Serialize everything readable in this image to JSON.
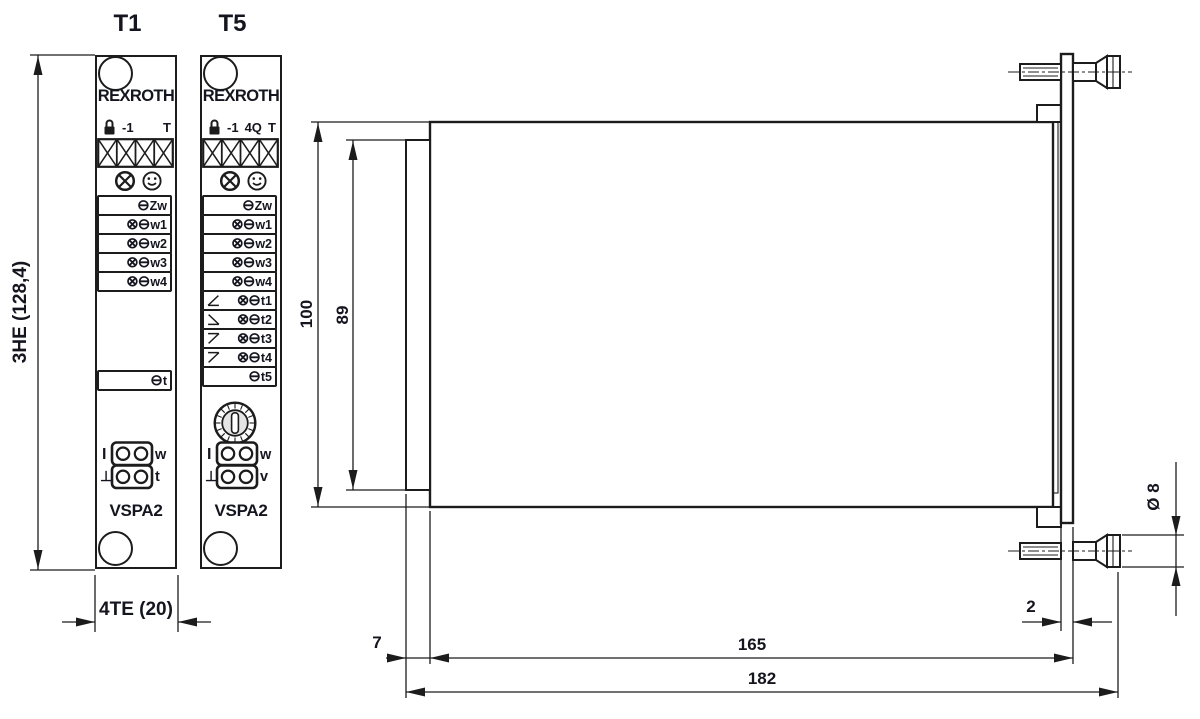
{
  "drawing": {
    "front_views": [
      {
        "title": "T1",
        "brand": "REXROTH",
        "header_items": [
          "-1",
          "T"
        ],
        "indicator_icons": [
          "circled-cross",
          "smiley"
        ],
        "test_points": [
          {
            "sym": "⊖",
            "label": "Zw"
          },
          {
            "sym": "⊗⊖",
            "label": "w1"
          },
          {
            "sym": "⊗⊖",
            "label": "w2"
          },
          {
            "sym": "⊗⊖",
            "label": "w3"
          },
          {
            "sym": "⊗⊖",
            "label": "w4"
          }
        ],
        "lower_test_point": {
          "sym": "⊖",
          "label": "t"
        },
        "jack_labels": {
          "top_left": "I",
          "bottom_left": "⊥",
          "top_right": "w",
          "bottom_right": "t"
        },
        "model": "VSPA2"
      },
      {
        "title": "T5",
        "brand": "REXROTH",
        "header_items": [
          "-1",
          "4Q",
          "T"
        ],
        "indicator_icons": [
          "circled-cross",
          "smiley"
        ],
        "test_points": [
          {
            "sym": "⊖",
            "label": "Zw"
          },
          {
            "sym": "⊗⊖",
            "label": "w1"
          },
          {
            "sym": "⊗⊖",
            "label": "w2"
          },
          {
            "sym": "⊗⊖",
            "label": "w3"
          },
          {
            "sym": "⊗⊖",
            "label": "w4"
          },
          {
            "sym": "⊗⊖",
            "label": "t1",
            "ramp_icon": "ramp-up"
          },
          {
            "sym": "⊗⊖",
            "label": "t2",
            "ramp_icon": "ramp-down"
          },
          {
            "sym": "⊗⊖",
            "label": "t3",
            "ramp_icon": "ramp-up-inverse"
          },
          {
            "sym": "⊗⊖",
            "label": "t4",
            "ramp_icon": "ramp-down-inverse"
          },
          {
            "sym": "⊖",
            "label": "t5"
          }
        ],
        "rotary_switch": "hex-code-switch",
        "jack_labels": {
          "top_left": "I",
          "bottom_left": "⊥",
          "top_right": "w",
          "bottom_right": "v"
        },
        "model": "VSPA2"
      }
    ],
    "dims": {
      "front_height": "3HE (128,4)",
      "front_width": "4TE (20)",
      "side_height_total": "100",
      "side_height_front": "89",
      "connector_depth": "7",
      "length_board": "165",
      "length_total": "182",
      "plate_thickness": "2",
      "screw_diameter": "Ø 8"
    },
    "line_color": "#1c1c1c"
  }
}
